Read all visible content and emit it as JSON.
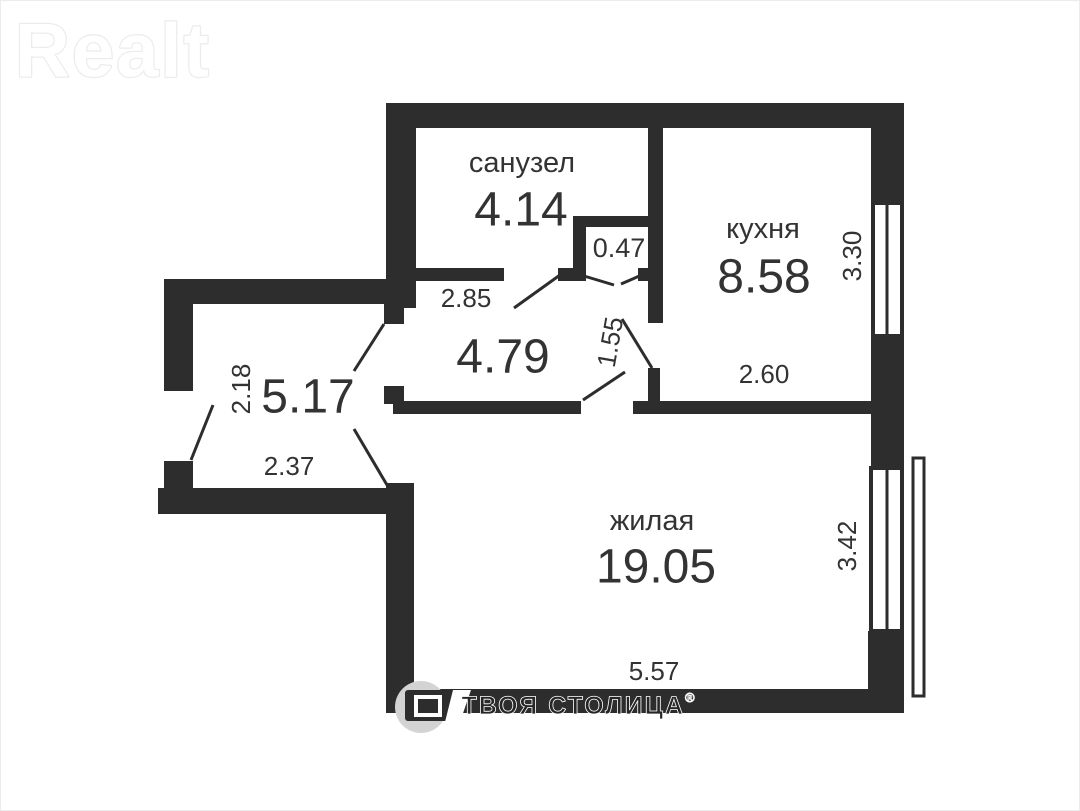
{
  "brand": {
    "logo_text": "Realt"
  },
  "watermark": {
    "company": "ТВОЯ СТОЛИЦА",
    "reg_mark": "®"
  },
  "colors": {
    "wall": "#2d2d2d",
    "text": "#333333",
    "logo_outline": "#ececec",
    "watermark_circle": "#d3d3d3",
    "watermark_text": "#262626"
  },
  "plan": {
    "rooms": {
      "bathroom": {
        "label": "санузел",
        "area": "4.14"
      },
      "storage": {
        "area": "0.47"
      },
      "kitchen": {
        "label": "кухня",
        "area": "8.58"
      },
      "hallway": {
        "area": "4.79"
      },
      "entry": {
        "area": "5.17"
      },
      "living": {
        "label": "жилая",
        "area": "19.05"
      }
    },
    "dimensions": {
      "bathroom_width": "2.85",
      "kitchen_door_width": "1.55",
      "kitchen_depth": "3.30",
      "kitchen_width": "2.60",
      "entry_depth": "2.18",
      "entry_width": "2.37",
      "living_depth": "3.42",
      "living_width": "5.57"
    }
  }
}
